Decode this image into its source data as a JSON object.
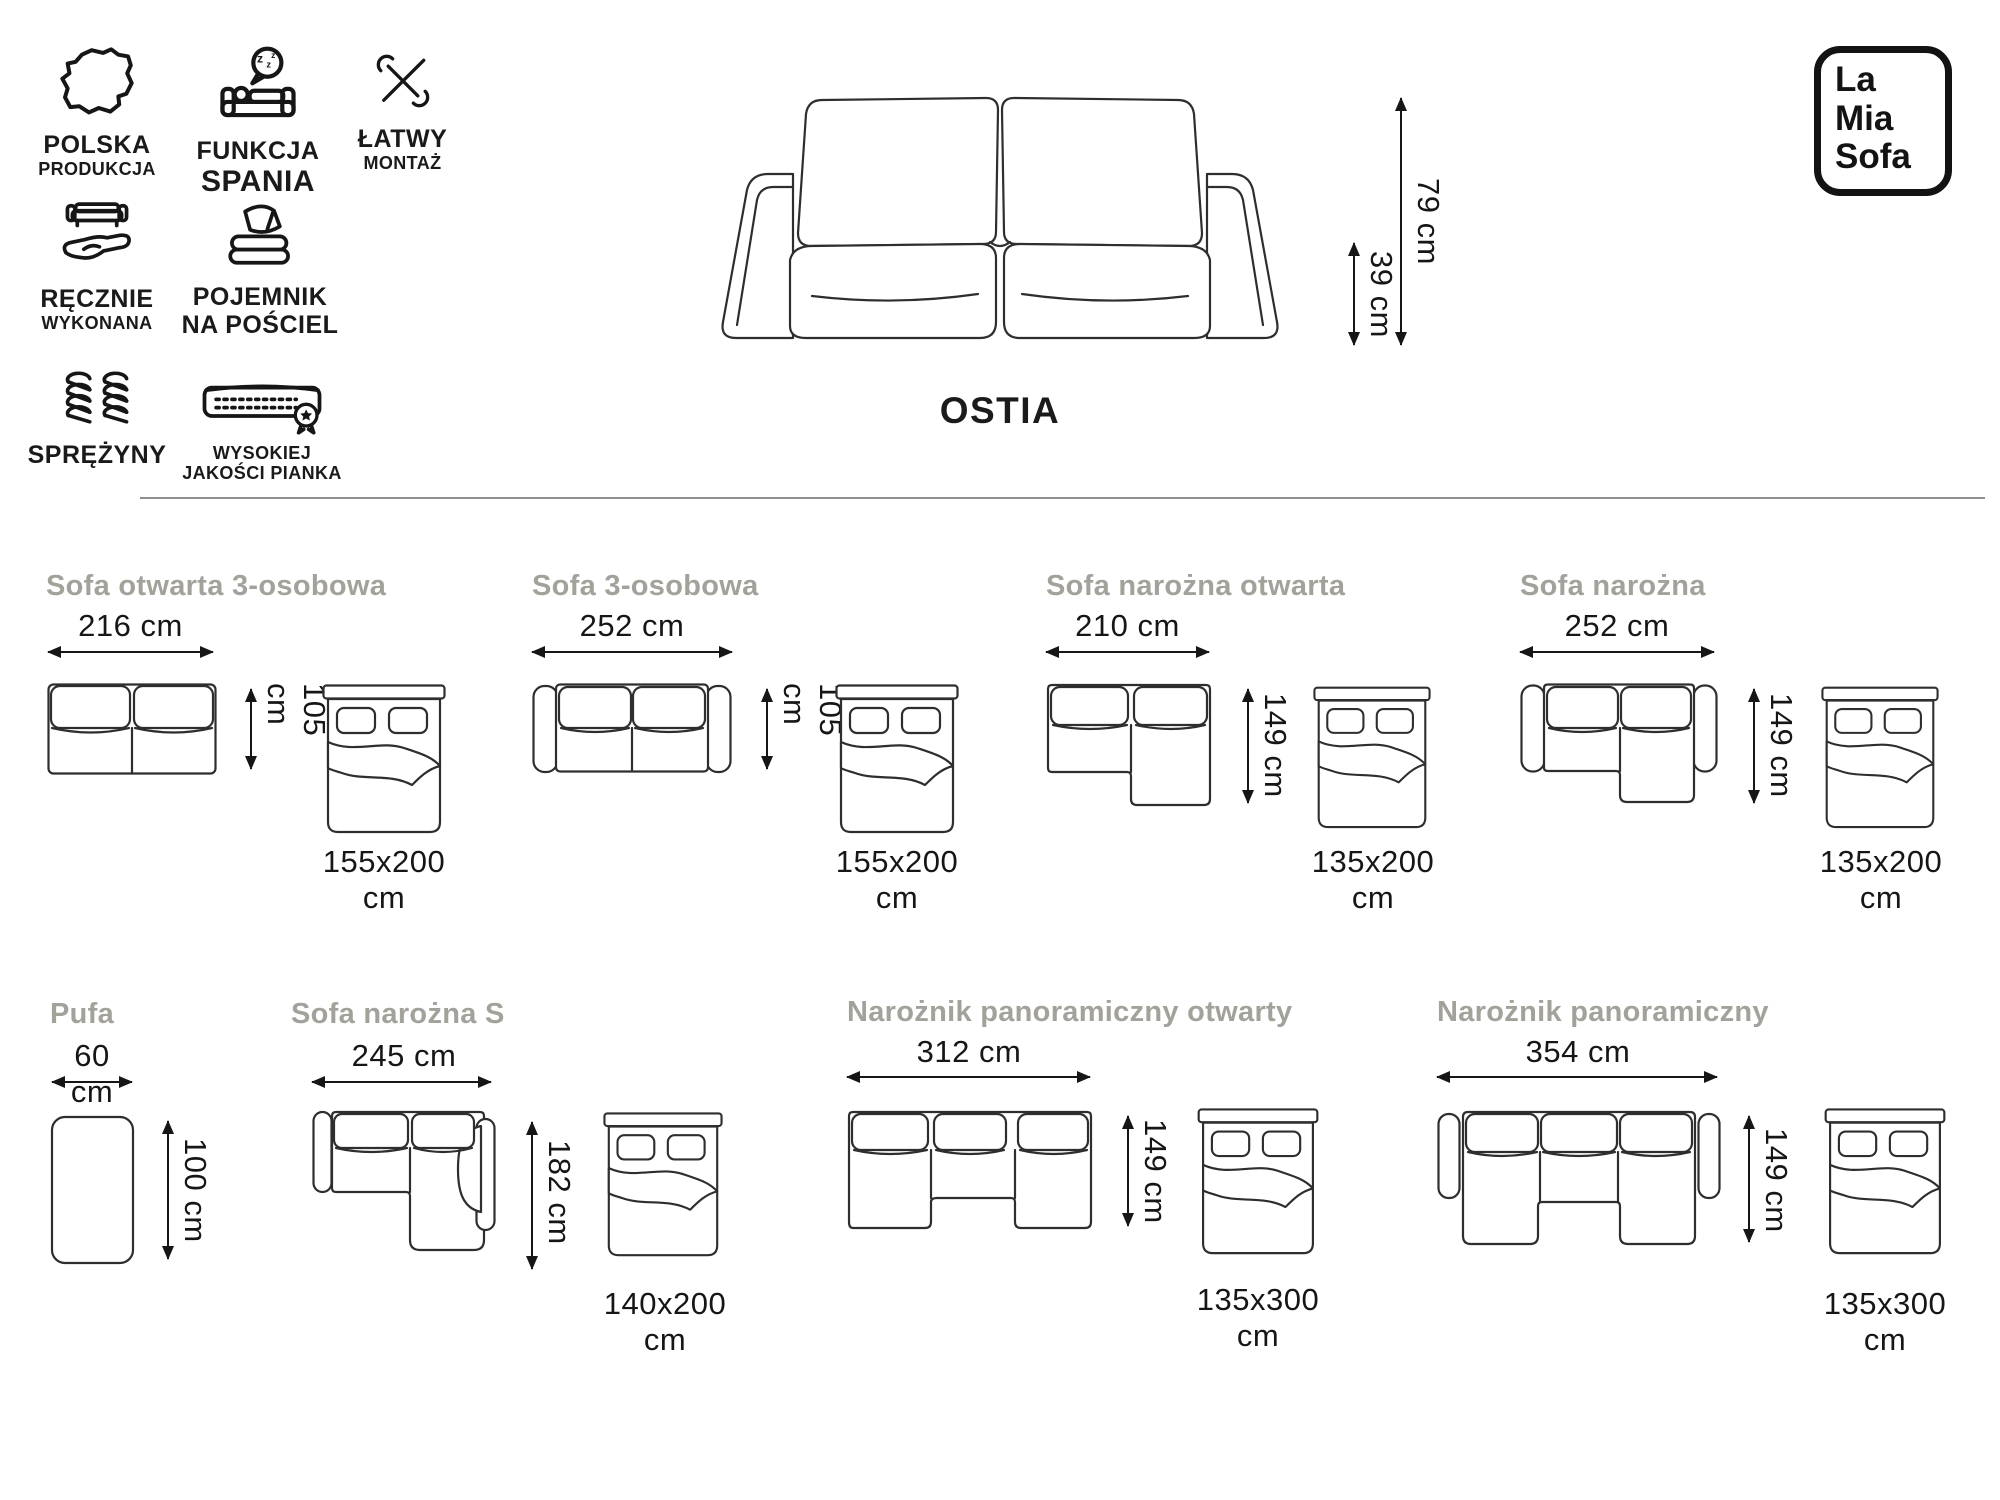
{
  "brand": {
    "line1": "La",
    "line2": "Mia",
    "line3": "Sofa"
  },
  "hero": {
    "title": "OSTIA",
    "total_height": "79 cm",
    "seat_height": "39 cm"
  },
  "features": [
    {
      "icon": "poland-map-icon",
      "line1": "POLSKA",
      "line2": "PRODUKCJA"
    },
    {
      "icon": "sleep-function-icon",
      "line1": "FUNKCJA",
      "line2": "SPANIA"
    },
    {
      "icon": "easy-assembly-icon",
      "line1": "ŁATWY",
      "line2": "MONTAŻ"
    },
    {
      "icon": "handmade-icon",
      "line1": "RĘCZNIE",
      "line2": "WYKONANA"
    },
    {
      "icon": "bedding-storage-icon",
      "line1": "POJEMNIK",
      "line2": "NA POŚCIEL"
    },
    {
      "icon": "springs-icon",
      "line1": "SPRĘŻYNY",
      "line2": ""
    },
    {
      "icon": "foam-quality-icon",
      "line1": "WYSOKIEJ",
      "line2": "JAKOŚCI PIANKA"
    }
  ],
  "variants": [
    {
      "name": "Sofa otwarta 3-osobowa",
      "width": "216 cm",
      "depth": "105 cm",
      "bed": "155x200 cm"
    },
    {
      "name": "Sofa 3-osobowa",
      "width": "252 cm",
      "depth": "105 cm",
      "bed": "155x200 cm"
    },
    {
      "name": "Sofa narożna otwarta",
      "width": "210 cm",
      "depth": "149 cm",
      "bed": "135x200 cm"
    },
    {
      "name": "Sofa narożna",
      "width": "252 cm",
      "depth": "149 cm",
      "bed": "135x200 cm"
    },
    {
      "name": "Pufa",
      "width": "60 cm",
      "depth": "100 cm",
      "bed": ""
    },
    {
      "name": "Sofa narożna S",
      "width": "245 cm",
      "depth": "182 cm",
      "bed": "140x200 cm"
    },
    {
      "name": "Narożnik panoramiczny otwarty",
      "width": "312 cm",
      "depth": "149 cm",
      "bed": "135x300 cm"
    },
    {
      "name": "Narożnik panoramiczny",
      "width": "354 cm",
      "depth": "149 cm",
      "bed": "135x300 cm"
    }
  ],
  "colors": {
    "heading_gray": "#a3a29a",
    "line_dark": "#1a1a1a",
    "divider_gray": "#8f8f8f"
  }
}
